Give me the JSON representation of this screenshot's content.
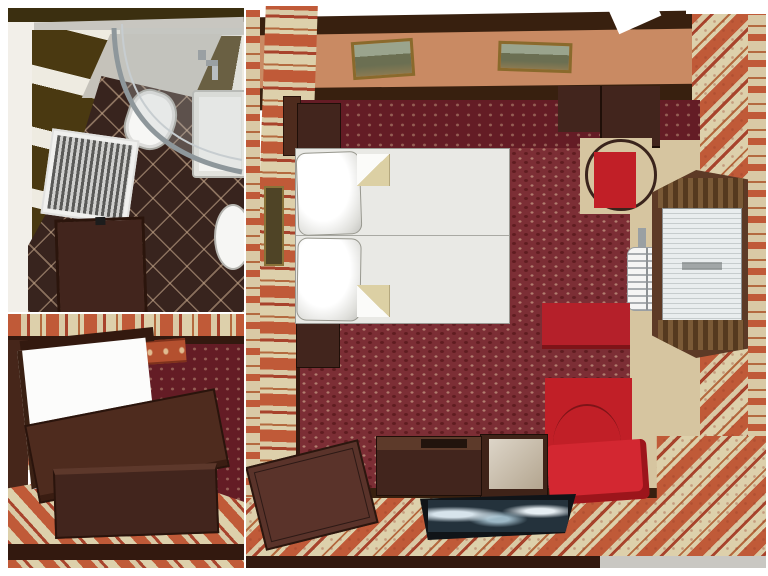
{
  "meta": {
    "title": "3D interior visualization — hotel guest room: bedroom floor plan with bathroom plan and perspective inset",
    "render_type": "architectural cutaway top view",
    "background": "#ffffff"
  },
  "palette": {
    "wood_dark": "#42251d",
    "wood_mid": "#5a332a",
    "wood_deep": "#33190f",
    "wood_edge": "#38200f",
    "carpet_red": "#7c2e35",
    "carpet_dark": "#641c25",
    "stripe_red": "#c05a38",
    "stripe_beige": "#d9c9a5",
    "accent_red": "#c11f27",
    "bench_red": "#b5202a",
    "cushion_red": "#d32731",
    "linen_white": "#e9e9e5",
    "floor_beige": "#d6c5a0",
    "gray_strip": "#c9c7c2",
    "chrome": "#98a1a5",
    "olive_tile": "#4a3911",
    "bath_floor": "#38241e",
    "tv_frame": "#101418",
    "tv_screen": "#24323c"
  },
  "views": {
    "bathroom_plan": {
      "label": "bathroom top view",
      "items": [
        "dark-tiled-walls",
        "panel-radiator",
        "vanity-cabinet",
        "corner-shower-glass",
        "bathtub",
        "washbasin",
        "toilet",
        "shower-mixer",
        "diagonal-floor-tiles"
      ]
    },
    "room_perspective": {
      "label": "bedroom corner perspective view",
      "items": [
        "striped-wallpaper-border",
        "wood-beam",
        "damask-wall",
        "striped-wallpaper",
        "bed-white-panel",
        "wood-table-top",
        "wood-chest",
        "striped-carpet",
        "skirting"
      ]
    },
    "bedroom_plan": {
      "label": "bedroom top view",
      "items": [
        "striped-wallpaper-walls",
        "framed-picture-1",
        "framed-picture-2",
        "framed-picture-small",
        "entry-door",
        "wardrobe-nightstand",
        "double-bed",
        "pillows",
        "folded-blanket-corners",
        "nightstand",
        "corner-dressing-table",
        "round-back-chair",
        "towel-radiator",
        "window-with-blinds",
        "curtains",
        "red-bench",
        "red-armchair",
        "red-cushion",
        "marble-top-cube-table",
        "console-table",
        "flat-screen-tv",
        "dark-floor-panel",
        "red-carpet",
        "wood-floor-border"
      ]
    }
  }
}
